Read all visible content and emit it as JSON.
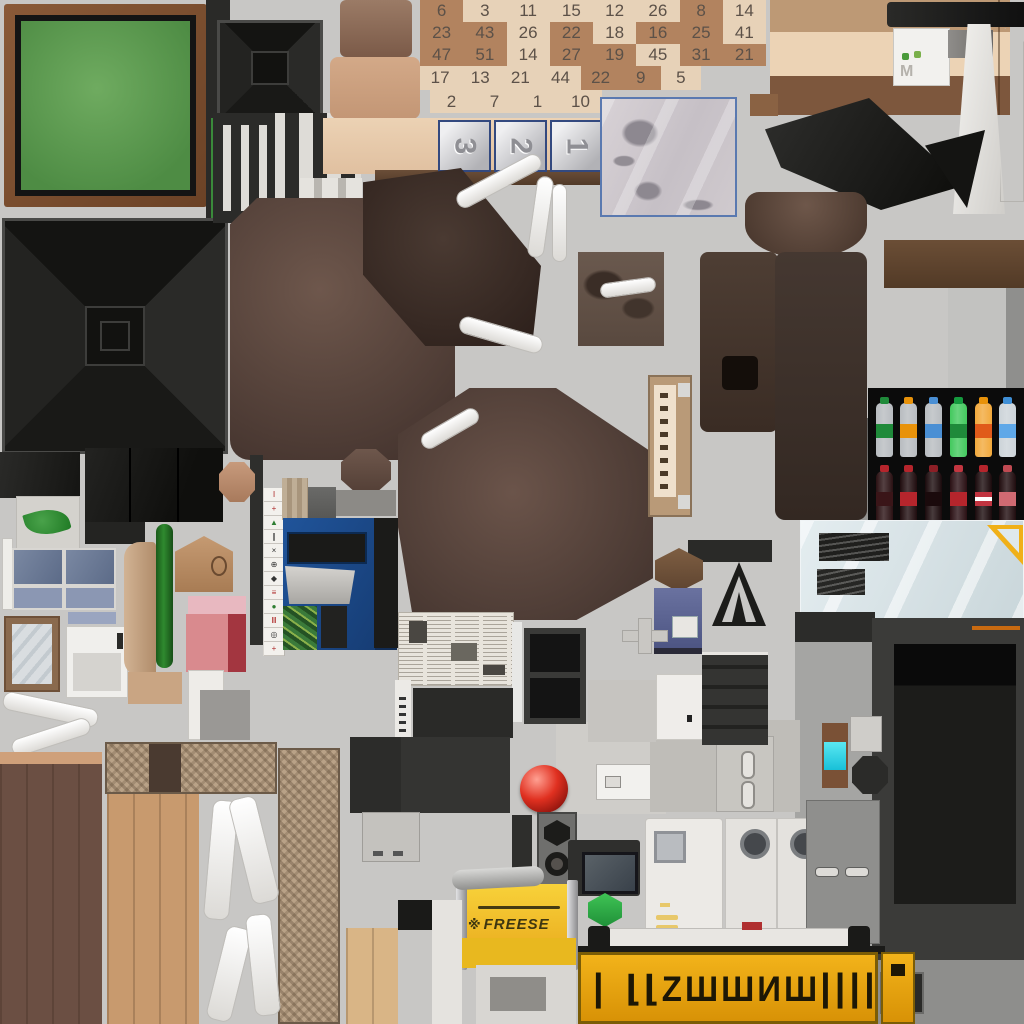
{
  "meta": {
    "background": "#c8c7c5",
    "sheet_size": "1024x1024"
  },
  "bingo_card": {
    "light": "#e7d2b8",
    "dark": "#b2835f",
    "ink": "#5c5148",
    "rows": [
      [
        {
          "v": "6",
          "d": 1
        },
        {
          "v": "3",
          "d": 0
        },
        {
          "v": "11",
          "d": 0
        },
        {
          "v": "15",
          "d": 0
        },
        {
          "v": "12",
          "d": 0
        },
        {
          "v": "26",
          "d": 0
        },
        {
          "v": "8",
          "d": 1
        },
        {
          "v": "14",
          "d": 0
        }
      ],
      [
        {
          "v": "23",
          "d": 1
        },
        {
          "v": "43",
          "d": 1
        },
        {
          "v": "26",
          "d": 0
        },
        {
          "v": "22",
          "d": 1
        },
        {
          "v": "18",
          "d": 0
        },
        {
          "v": "16",
          "d": 1
        },
        {
          "v": "25",
          "d": 1
        },
        {
          "v": "41",
          "d": 0
        }
      ],
      [
        {
          "v": "47",
          "d": 1
        },
        {
          "v": "51",
          "d": 1
        },
        {
          "v": "14",
          "d": 0
        },
        {
          "v": "27",
          "d": 1
        },
        {
          "v": "19",
          "d": 1
        },
        {
          "v": "45",
          "d": 0
        },
        {
          "v": "31",
          "d": 1
        },
        {
          "v": "21",
          "d": 1
        }
      ],
      [
        {
          "v": "17",
          "d": 0
        },
        {
          "v": "13",
          "d": 0
        },
        {
          "v": "21",
          "d": 0
        },
        {
          "v": "44",
          "d": 0
        },
        {
          "v": "22",
          "d": 1
        },
        {
          "v": "9",
          "d": 1
        },
        {
          "v": "5",
          "d": 0
        }
      ],
      [
        {
          "v": "2",
          "d": 0
        },
        {
          "v": "7",
          "d": 0
        },
        {
          "v": "1",
          "d": 0
        },
        {
          "v": "10",
          "d": 0
        }
      ]
    ]
  },
  "countdown_tiles": {
    "labels": [
      "3",
      "2",
      "1"
    ],
    "border": "#33497f",
    "face": "#d8d8da",
    "digit": "#8f8f94"
  },
  "drink_cooler": {
    "bg": "#0b0b0b",
    "top_row": [
      {
        "cap": "#1f8a3a",
        "body": "#b8bcc0",
        "label": "#1f8a3a"
      },
      {
        "cap": "#e8920a",
        "body": "#b8bcc0",
        "label": "#e8920a"
      },
      {
        "cap": "#4a8fd4",
        "body": "#b8bcc0",
        "label": "#4a8fd4"
      },
      {
        "cap": "#159a3e",
        "body": "#43c95e",
        "label": "#1f8a3a"
      },
      {
        "cap": "#e8920a",
        "body": "#f2a93c",
        "label": "#e05a1a"
      },
      {
        "cap": "#3f8fd6",
        "body": "#ccd3d8",
        "label": "#5fa8e8"
      }
    ],
    "bottom_row": [
      {
        "cap": "#b5252c",
        "body": "#2a1113",
        "label": "#3a1518",
        "stripe": false
      },
      {
        "cap": "#b5252c",
        "body": "#1f0c0e",
        "label": "#b5252c",
        "stripe": false
      },
      {
        "cap": "#8c1f26",
        "body": "#1a0a0c",
        "label": "#1a0a0c",
        "stripe": false
      },
      {
        "cap": "#c33640",
        "body": "#2a1014",
        "label": "#b5252c",
        "stripe": false
      },
      {
        "cap": "#b5252c",
        "body": "#1a0a0c",
        "label": "#c13440",
        "stripe": true
      },
      {
        "cap": "#c04a52",
        "body": "#200c0e",
        "label": "#d06a72",
        "stripe": false
      }
    ]
  },
  "mahjong_strip": {
    "tiles": [
      {
        "g": "Ⅰ",
        "c": "#b03030"
      },
      {
        "g": "+",
        "c": "#b03030"
      },
      {
        "g": "▲",
        "c": "#2e7d32"
      },
      {
        "g": "∥",
        "c": "#333333"
      },
      {
        "g": "×",
        "c": "#333333"
      },
      {
        "g": "⊕",
        "c": "#333333"
      },
      {
        "g": "◆",
        "c": "#333333"
      },
      {
        "g": "≡",
        "c": "#b03030"
      },
      {
        "g": "●",
        "c": "#2e7d32"
      },
      {
        "g": "Ⅲ",
        "c": "#b03030"
      },
      {
        "g": "◎",
        "c": "#333333"
      },
      {
        "g": "+",
        "c": "#b03030"
      }
    ]
  },
  "cheese_stand": {
    "paw_icon": "※",
    "text": "FREESE",
    "bg": "#f5c518",
    "ink": "#3e3610"
  },
  "alien_sign": {
    "left": "|",
    "main": "⌊⌊ΖШШИШ",
    "right": "||||",
    "bg": "#e8a20b",
    "ink": "#1d1705"
  },
  "palette": {
    "background": "#c8c7c5",
    "frame_green": "#5f9e52",
    "frame_wood": "#7a4a2e",
    "cabinet_blue": "#1d4a8c",
    "sign_gold": "#e8a20b",
    "cheese_yellow": "#f5c518",
    "sphere_red": "#d92318",
    "hex_green": "#2fae44",
    "cyan_chip": "#2fd8e8",
    "leather_brown": "#5a453c",
    "wood_dark": "#6b4f43",
    "wood_light": "#c89a6e",
    "wicker": "#b9a287",
    "glass_blue": "#dfe9ec",
    "ruler_yellow": "#f0b018",
    "speaker_black": "#1e1e1c",
    "newsprint": "#e8e4dc"
  }
}
